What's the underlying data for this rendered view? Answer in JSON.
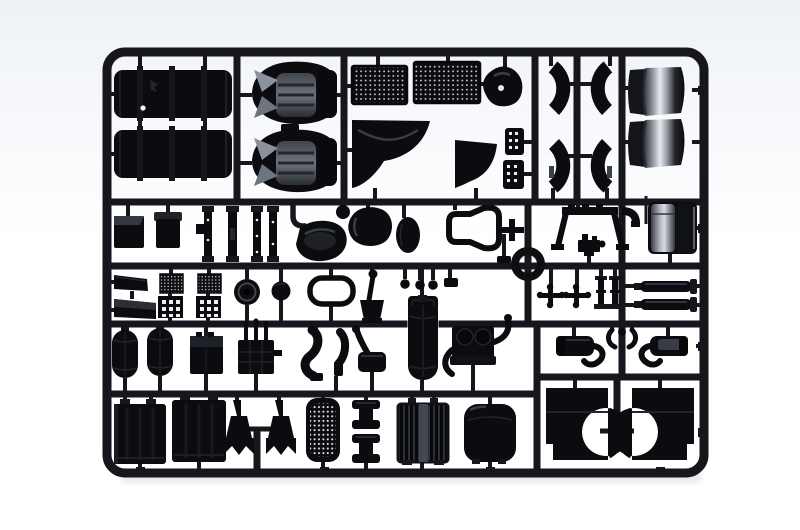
{
  "scene": {
    "type": "product-photo",
    "subject": "model kit sprue",
    "description": "Black injection-molded plastic model-kit sprue (parts tree) with truck model parts attached to a rounded rectangular runner frame, photographed on a white studio background",
    "material": "black styrene plastic",
    "background": "white studio backdrop",
    "frame_shape": "rounded rectangle with internal runner grid"
  },
  "colors": {
    "bgTop": "#edf0f5",
    "bgMain": "#ffffff",
    "plastic": "#16161d",
    "plasticDark": "#0b0b10",
    "plasticEdge": "#272b33",
    "grayMid": "#8b919a",
    "grayLight": "#d9dde2",
    "shadow": "#e2e5ea"
  },
  "parts": [
    {
      "name": "fuel-tank",
      "count": 2
    },
    {
      "name": "cab-seat",
      "count": 2
    },
    {
      "name": "mesh-grille-panel",
      "count": 2
    },
    {
      "name": "fender-panel",
      "count": 2
    },
    {
      "name": "cab-corner-panel",
      "count": 1
    },
    {
      "name": "pedal-plate",
      "count": 2
    },
    {
      "name": "mudguard-half",
      "count": 4
    },
    {
      "name": "wind-deflector",
      "count": 2
    },
    {
      "name": "equipment-box",
      "count": 2
    },
    {
      "name": "lever-slat",
      "count": 4
    },
    {
      "name": "air-horn-cover",
      "count": 1
    },
    {
      "name": "armrest-pad",
      "count": 2
    },
    {
      "name": "seat-back-frame",
      "count": 1
    },
    {
      "name": "towing-ring",
      "count": 1
    },
    {
      "name": "cab-rear-frame",
      "count": 1
    },
    {
      "name": "compressor-unit",
      "count": 1
    },
    {
      "name": "air-filter-box",
      "count": 1
    },
    {
      "name": "mud-flap",
      "count": 2
    },
    {
      "name": "step-plate",
      "count": 4
    },
    {
      "name": "brake-drum",
      "count": 1
    },
    {
      "name": "hub-cap",
      "count": 1
    },
    {
      "name": "window-gasket",
      "count": 1
    },
    {
      "name": "gear-lever",
      "count": 1
    },
    {
      "name": "control-knob",
      "count": 3
    },
    {
      "name": "console-box",
      "count": 1
    },
    {
      "name": "universal-joint",
      "count": 2
    },
    {
      "name": "chassis-stanchion",
      "count": 2
    },
    {
      "name": "exhaust-stack",
      "count": 2
    },
    {
      "name": "air-tank",
      "count": 2
    },
    {
      "name": "battery-box",
      "count": 1
    },
    {
      "name": "hydraulic-unit",
      "count": 1
    },
    {
      "name": "exhaust-pipe",
      "count": 2
    },
    {
      "name": "brake-pedal",
      "count": 1
    },
    {
      "name": "air-reservoir",
      "count": 1
    },
    {
      "name": "engine-block",
      "count": 1
    },
    {
      "name": "muffler",
      "count": 2
    },
    {
      "name": "pipe-hanger",
      "count": 2
    },
    {
      "name": "radiator-panel",
      "count": 2
    },
    {
      "name": "spring-hanger",
      "count": 2
    },
    {
      "name": "intake-grille",
      "count": 1
    },
    {
      "name": "wheel-rim",
      "count": 2
    },
    {
      "name": "ribbed-radiator",
      "count": 1
    },
    {
      "name": "storage-box",
      "count": 1
    },
    {
      "name": "cab-side-panel",
      "count": 2
    }
  ]
}
